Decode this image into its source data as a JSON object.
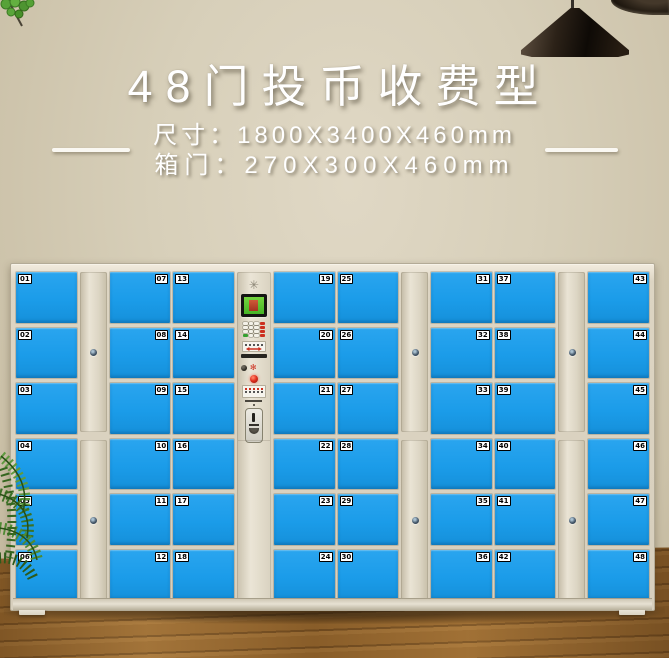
{
  "header": {
    "title": "48门投币收费型",
    "spec_size_label": "尺寸：",
    "spec_size_value": "1800X3400X460mm",
    "spec_door_label": "箱门：",
    "spec_door_value": "270X300X460mm"
  },
  "locker": {
    "door_count": 48,
    "columns": [
      {
        "type": "doors",
        "number_side": "left",
        "numbers": [
          "01",
          "02",
          "03",
          "04",
          "05",
          "06"
        ]
      },
      {
        "type": "divider"
      },
      {
        "type": "doors",
        "number_side": "right",
        "numbers": [
          "07",
          "08",
          "09",
          "10",
          "11",
          "12"
        ]
      },
      {
        "type": "doors",
        "number_side": "left",
        "numbers": [
          "13",
          "14",
          "15",
          "16",
          "17",
          "18"
        ]
      },
      {
        "type": "panel"
      },
      {
        "type": "doors",
        "number_side": "right",
        "numbers": [
          "19",
          "20",
          "21",
          "22",
          "23",
          "24"
        ]
      },
      {
        "type": "doors",
        "number_side": "left",
        "numbers": [
          "25",
          "26",
          "27",
          "28",
          "29",
          "30"
        ]
      },
      {
        "type": "divider"
      },
      {
        "type": "doors",
        "number_side": "right",
        "numbers": [
          "31",
          "32",
          "33",
          "34",
          "35",
          "36"
        ]
      },
      {
        "type": "doors",
        "number_side": "left",
        "numbers": [
          "37",
          "38",
          "39",
          "40",
          "41",
          "42"
        ]
      },
      {
        "type": "divider"
      },
      {
        "type": "doors",
        "number_side": "right",
        "numbers": [
          "43",
          "44",
          "45",
          "46",
          "47",
          "48"
        ]
      }
    ],
    "panel": {
      "vent_glyph": "✳",
      "spark_glyph": "✻"
    },
    "colors": {
      "door_blue": "#1b9ce9",
      "door_blue_light": "#2aa5ef",
      "accent_red": "#cc2f1f",
      "cabinet_beige": "#ddd5c3",
      "screen_green": "#5cc433"
    }
  }
}
